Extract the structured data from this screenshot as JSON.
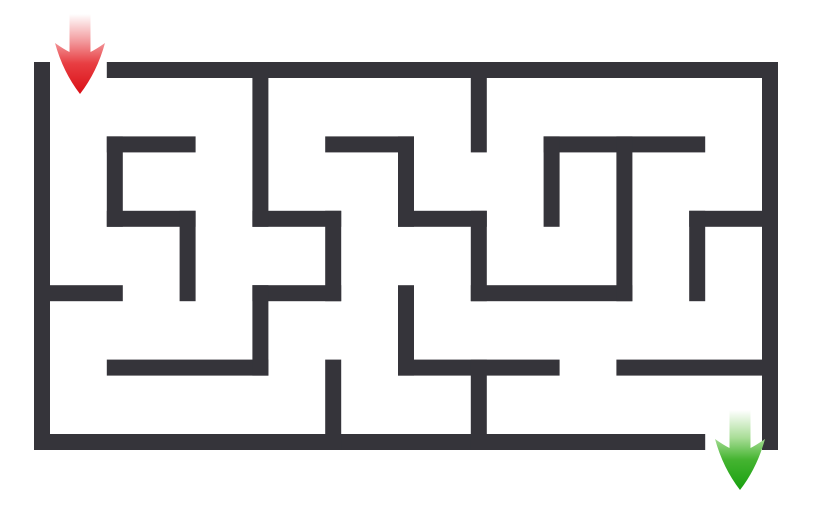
{
  "maze": {
    "background_color": "#ffffff",
    "wall_color": "#35343a",
    "wall_thickness": 16,
    "grid": {
      "cols": 10,
      "rows": 5,
      "x0": 42,
      "y0": 70,
      "cell_w": 72.8,
      "cell_h": 74.4
    },
    "entrance": {
      "side": "top",
      "cell_col": 0
    },
    "exit": {
      "side": "bottom",
      "cell_col": 9
    },
    "walls": {
      "horizontal": [
        [
          0,
          1,
          10
        ],
        [
          1,
          1,
          2
        ],
        [
          1,
          4,
          5
        ],
        [
          1,
          7,
          9
        ],
        [
          2,
          1,
          2
        ],
        [
          2,
          3,
          4
        ],
        [
          2,
          5,
          6
        ],
        [
          2,
          9,
          10
        ],
        [
          3,
          0,
          1
        ],
        [
          3,
          3,
          4
        ],
        [
          3,
          6,
          8
        ],
        [
          4,
          1,
          3
        ],
        [
          4,
          5,
          7
        ],
        [
          4,
          8,
          10
        ],
        [
          5,
          0,
          9
        ]
      ],
      "vertical": [
        [
          0,
          0,
          5
        ],
        [
          1,
          1,
          2
        ],
        [
          2,
          2,
          3
        ],
        [
          3,
          0,
          2
        ],
        [
          3,
          3,
          4
        ],
        [
          4,
          2,
          3
        ],
        [
          4,
          4,
          5
        ],
        [
          5,
          1,
          2
        ],
        [
          5,
          3,
          4
        ],
        [
          6,
          0,
          1
        ],
        [
          6,
          2,
          3
        ],
        [
          6,
          4,
          5
        ],
        [
          7,
          1,
          2
        ],
        [
          8,
          1,
          3
        ],
        [
          9,
          2,
          3
        ],
        [
          10,
          0,
          5
        ]
      ]
    },
    "arrows": [
      {
        "name": "start-arrow",
        "direction": "down",
        "color": "#e01b22",
        "x": 80,
        "y": 14,
        "length": 80,
        "shaft_width": 21,
        "shaft_length": 38,
        "head_width": 50,
        "gradient": [
          "#ffffff",
          "#f2979a",
          "#e83e42",
          "#da0f16"
        ]
      },
      {
        "name": "end-arrow",
        "direction": "down",
        "color": "#2aa821",
        "x": 740,
        "y": 410,
        "length": 80,
        "shaft_width": 21,
        "shaft_length": 38,
        "head_width": 50,
        "gradient": [
          "#ffffff",
          "#a8dd96",
          "#45b431",
          "#18a00f"
        ]
      }
    ]
  }
}
